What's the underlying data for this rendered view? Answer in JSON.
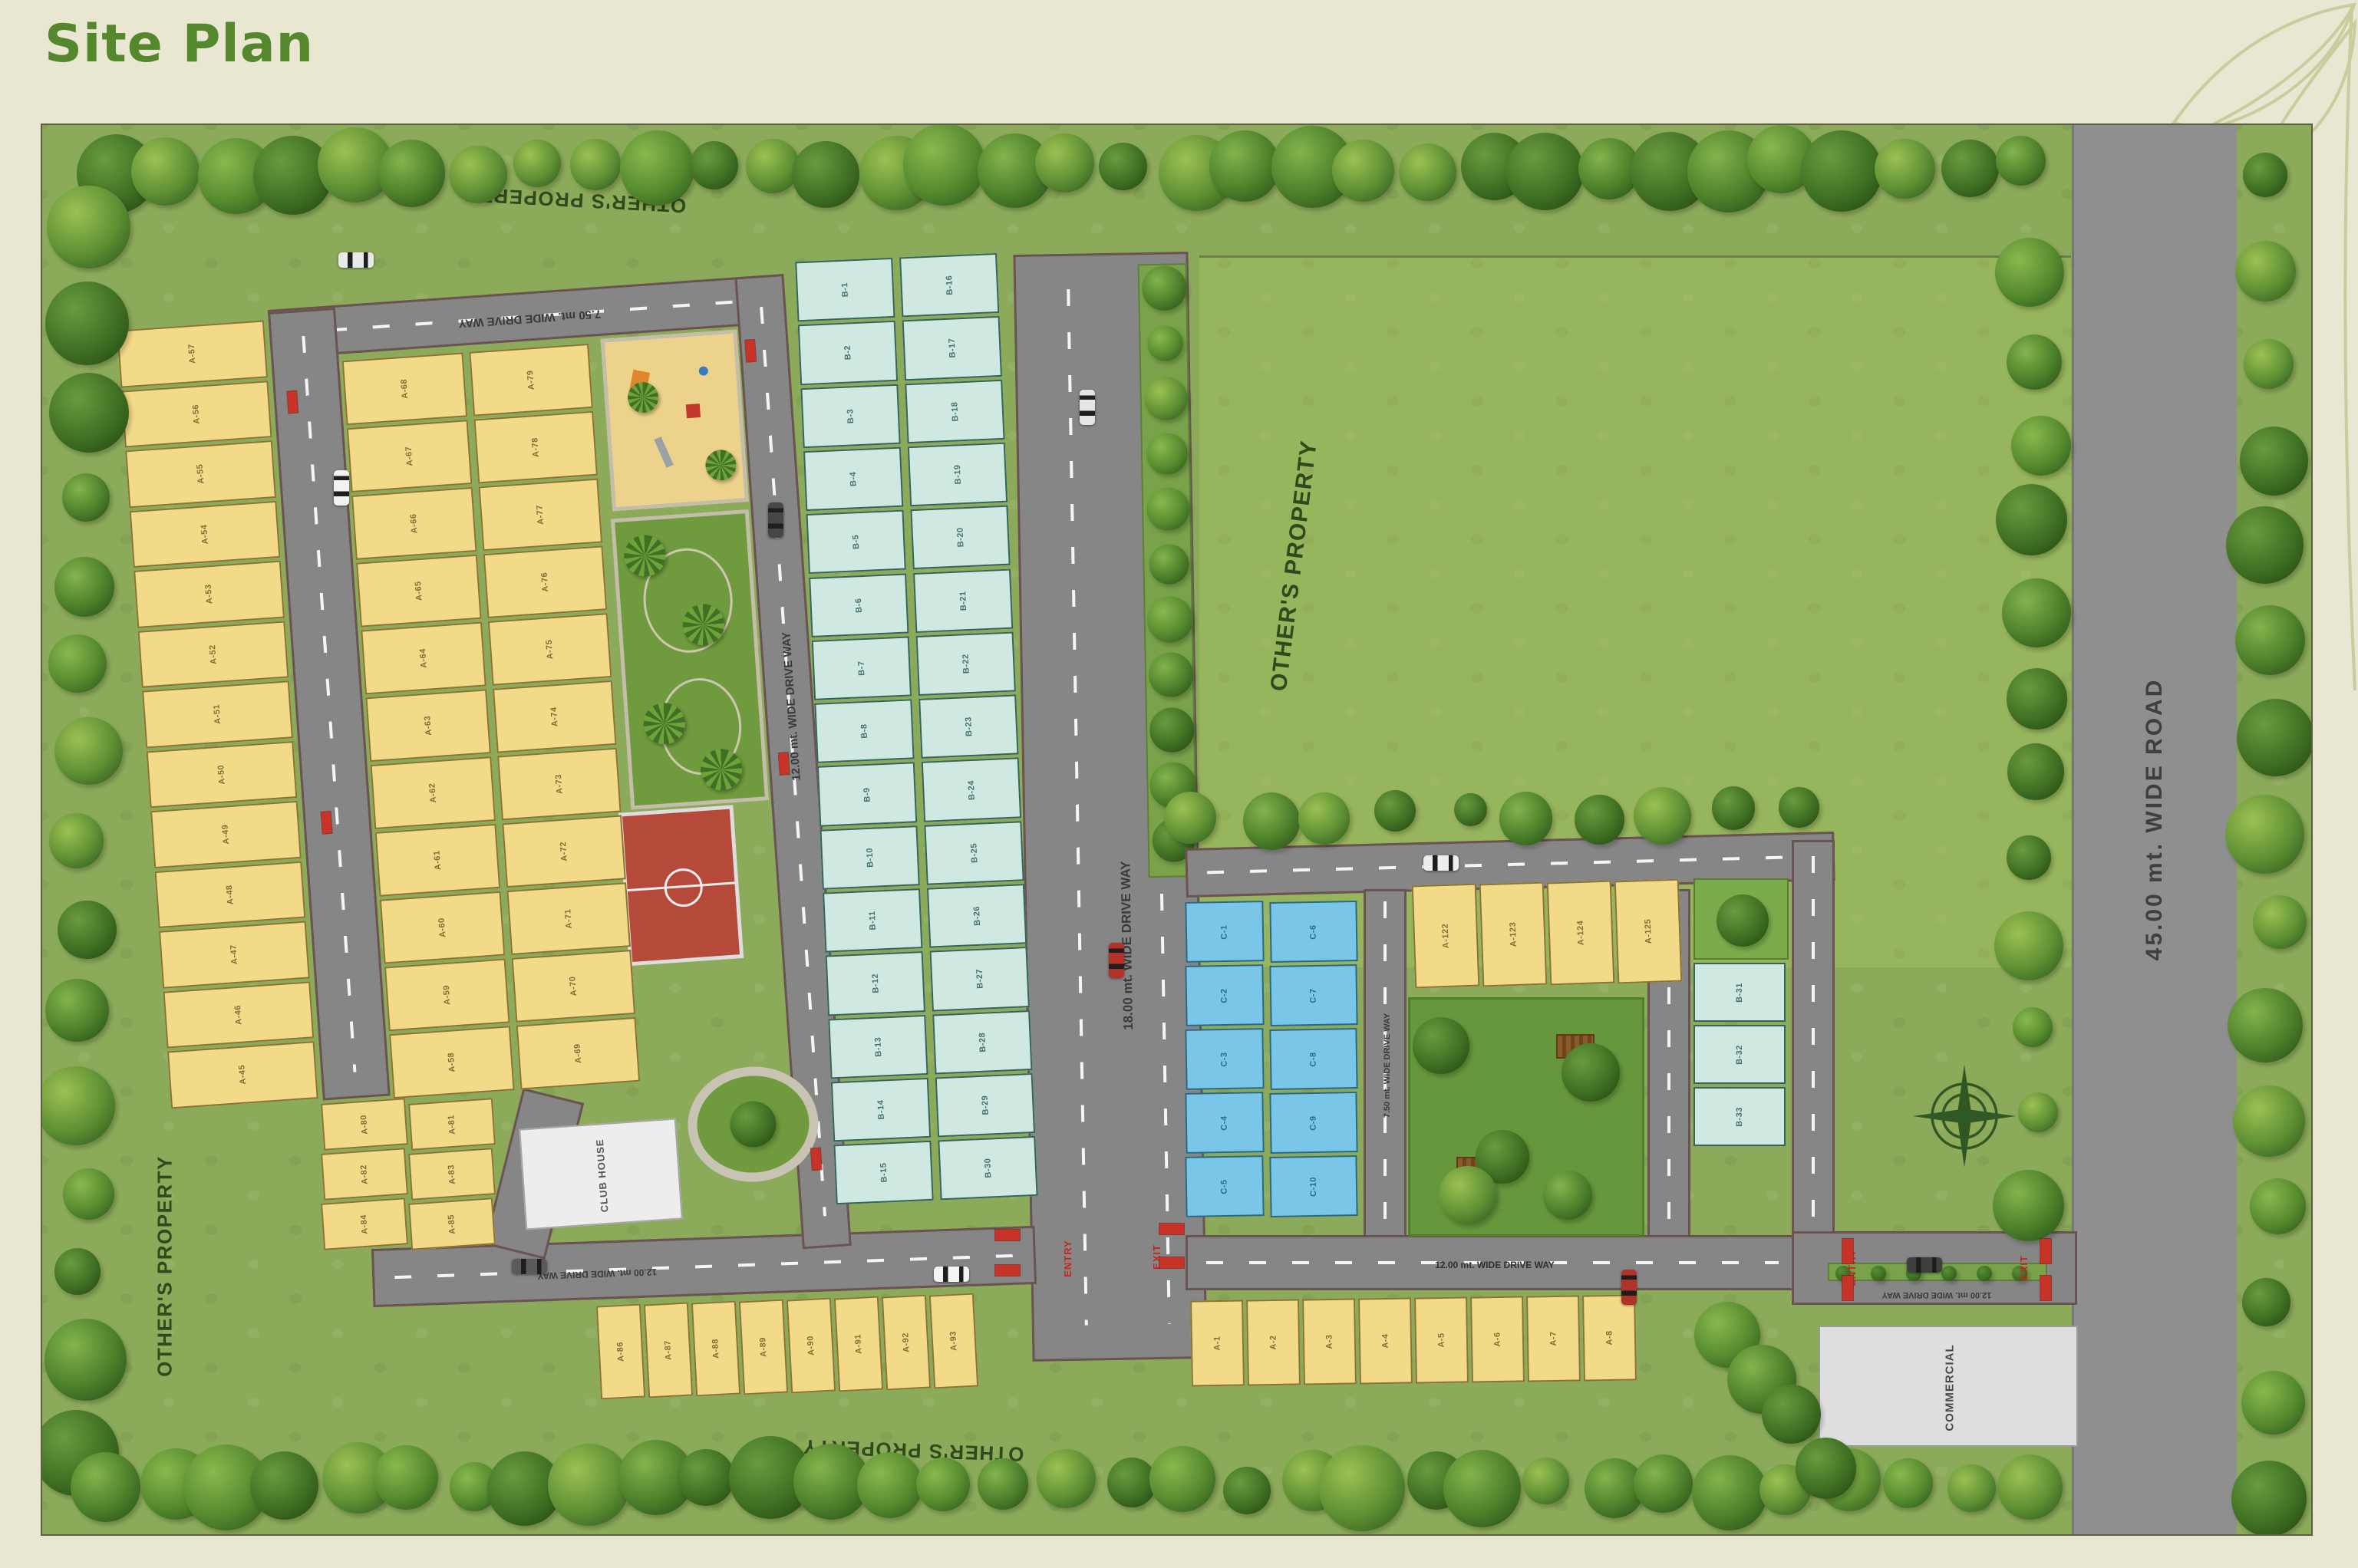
{
  "page": {
    "title": "Site Plan"
  },
  "boundaries": {
    "others_property": "OTHER'S PROPERTY"
  },
  "roads": {
    "main_road": "45.00 mt. WIDE ROAD",
    "drive_18": "18.00 mt. WIDE DRIVE WAY",
    "drive_12": "12.00 mt. WIDE DRIVE WAY",
    "drive_75": "7.50 mt. WIDE DRIVE WAY"
  },
  "amenities": {
    "club_house": "CLUB HOUSE",
    "commercial": "COMMERCIAL"
  },
  "gates": {
    "entry": "ENTRY",
    "exit": "EXIT"
  },
  "colors": {
    "title_green": "#55872d",
    "grass": "#8cab5a",
    "road_gray": "#868686",
    "plot_yellow": "#f3da88",
    "plot_teal": "#cfe8e1",
    "plot_blue": "#79c6e8",
    "gate_red": "#c83227"
  },
  "plot_groups": [
    {
      "id": "left_outer",
      "type": "yellow",
      "labels": [
        "A-57",
        "A-56",
        "A-55",
        "A-54",
        "A-53",
        "A-52",
        "A-51",
        "A-50",
        "A-49",
        "A-48",
        "A-47",
        "A-46",
        "A-45"
      ]
    },
    {
      "id": "inner_west",
      "type": "yellow",
      "labels": [
        "A-68",
        "A-67",
        "A-66",
        "A-65",
        "A-64",
        "A-63",
        "A-62",
        "A-61",
        "A-60",
        "A-59",
        "A-58"
      ]
    },
    {
      "id": "inner_east",
      "type": "yellow",
      "labels": [
        "A-79",
        "A-78",
        "A-77",
        "A-76",
        "A-75",
        "A-74",
        "A-73",
        "A-72",
        "A-71",
        "A-70",
        "A-69"
      ]
    },
    {
      "id": "bottom_left_block",
      "type": "yellow",
      "labels": [
        "A-80",
        "A-81",
        "A-82",
        "A-83",
        "A-84",
        "A-85"
      ]
    },
    {
      "id": "bottom_row_west",
      "type": "yellow",
      "labels": [
        "A-86",
        "A-87",
        "A-88",
        "A-89",
        "A-90",
        "A-91",
        "A-92",
        "A-93"
      ]
    },
    {
      "id": "bottom_row_east",
      "type": "yellow",
      "labels": [
        "A-1",
        "A-2",
        "A-3",
        "A-4",
        "A-5",
        "A-6",
        "A-7",
        "A-8"
      ]
    },
    {
      "id": "yellow_row_right",
      "type": "yellow",
      "labels": [
        "A-122",
        "A-123",
        "A-124",
        "A-125"
      ]
    },
    {
      "id": "teal_west",
      "type": "teal",
      "labels": [
        "B-1",
        "B-2",
        "B-3",
        "B-4",
        "B-5",
        "B-6",
        "B-7",
        "B-8",
        "B-9",
        "B-10",
        "B-11",
        "B-12",
        "B-13",
        "B-14",
        "B-15"
      ]
    },
    {
      "id": "teal_east",
      "type": "teal",
      "labels": [
        "B-16",
        "B-17",
        "B-18",
        "B-19",
        "B-20",
        "B-21",
        "B-22",
        "B-23",
        "B-24",
        "B-25",
        "B-26",
        "B-27",
        "B-28",
        "B-29",
        "B-30"
      ]
    },
    {
      "id": "teal_right",
      "type": "teal",
      "labels": [
        "B-31",
        "B-32",
        "B-33"
      ]
    },
    {
      "id": "blue_west",
      "type": "blue",
      "labels": [
        "C-1",
        "C-2",
        "C-3",
        "C-4",
        "C-5"
      ]
    },
    {
      "id": "blue_east",
      "type": "blue",
      "labels": [
        "C-6",
        "C-7",
        "C-8",
        "C-9",
        "C-10"
      ]
    }
  ]
}
